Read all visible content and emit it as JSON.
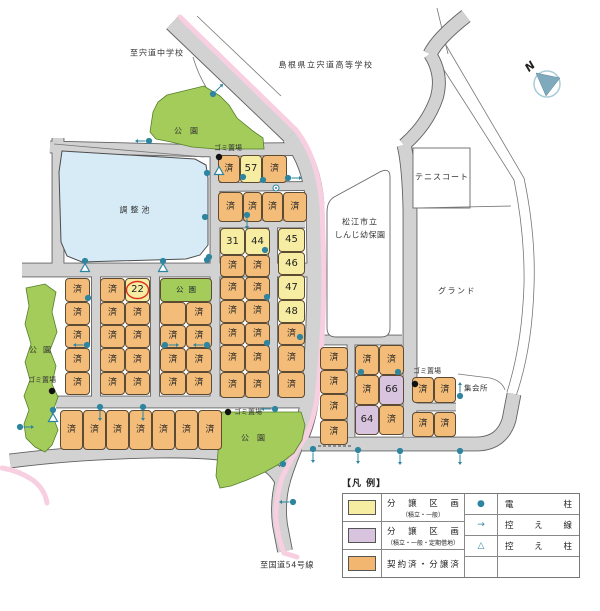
{
  "map": {
    "colors": {
      "sold_plot": "#f3bc79",
      "available_plot": "#f7eda2",
      "leasehold_plot": "#d9c4e0",
      "park": "#a3cc5a",
      "pond": "#d6ebf6",
      "road": "#d2d2d2",
      "road_edge_pink": "#f8cfe0",
      "symbol_teal": "#2e85a0",
      "highlight_red": "#e0301e"
    },
    "plots": [
      [
        218,
        155,
        22,
        28,
        "s",
        "済"
      ],
      [
        240,
        155,
        22,
        28,
        "y",
        "57"
      ],
      [
        262,
        155,
        25,
        28,
        "s",
        "済"
      ],
      [
        218,
        192,
        25,
        30,
        "s",
        "済"
      ],
      [
        243,
        192,
        19,
        30,
        "s",
        "済"
      ],
      [
        262,
        192,
        21,
        30,
        "s",
        "済"
      ],
      [
        283,
        192,
        24,
        30,
        "s",
        "済"
      ],
      [
        220,
        228,
        25,
        27,
        "y",
        "31"
      ],
      [
        245,
        228,
        25,
        27,
        "y",
        "44"
      ],
      [
        220,
        255,
        25,
        22,
        "s",
        "済"
      ],
      [
        245,
        255,
        25,
        22,
        "s",
        "済"
      ],
      [
        220,
        277,
        25,
        23,
        "s",
        "済"
      ],
      [
        245,
        277,
        25,
        23,
        "s",
        "済"
      ],
      [
        220,
        300,
        25,
        23,
        "s",
        "済"
      ],
      [
        245,
        300,
        25,
        23,
        "s",
        "済"
      ],
      [
        220,
        323,
        25,
        22,
        "s",
        "済"
      ],
      [
        245,
        323,
        25,
        22,
        "s",
        "済"
      ],
      [
        220,
        345,
        25,
        27,
        "s",
        "済"
      ],
      [
        245,
        345,
        25,
        27,
        "s",
        "済"
      ],
      [
        220,
        372,
        25,
        26,
        "s",
        "済"
      ],
      [
        245,
        372,
        25,
        26,
        "s",
        "済"
      ],
      [
        278,
        228,
        27,
        24,
        "y",
        "45"
      ],
      [
        278,
        252,
        27,
        23,
        "y",
        "46"
      ],
      [
        278,
        275,
        27,
        25,
        "y",
        "47"
      ],
      [
        278,
        300,
        27,
        23,
        "y",
        "48"
      ],
      [
        278,
        323,
        27,
        22,
        "s",
        "済"
      ],
      [
        278,
        345,
        27,
        27,
        "s",
        "済"
      ],
      [
        278,
        372,
        27,
        26,
        "s",
        "済"
      ],
      [
        65,
        278,
        25,
        24,
        "s",
        "済"
      ],
      [
        65,
        302,
        25,
        23,
        "s",
        "済"
      ],
      [
        65,
        325,
        25,
        23,
        "s",
        "済"
      ],
      [
        65,
        348,
        25,
        24,
        "s",
        "済"
      ],
      [
        65,
        372,
        25,
        23,
        "s",
        "済"
      ],
      [
        100,
        278,
        25,
        24,
        "s",
        "済"
      ],
      [
        125,
        278,
        25,
        24,
        "y",
        "22",
        1
      ],
      [
        100,
        302,
        25,
        23,
        "s",
        "済"
      ],
      [
        125,
        302,
        25,
        23,
        "s",
        "済"
      ],
      [
        100,
        325,
        25,
        23,
        "s",
        "済"
      ],
      [
        125,
        325,
        25,
        23,
        "s",
        "済"
      ],
      [
        100,
        348,
        25,
        24,
        "s",
        "済"
      ],
      [
        125,
        348,
        25,
        24,
        "s",
        "済"
      ],
      [
        100,
        372,
        25,
        23,
        "s",
        "済"
      ],
      [
        125,
        372,
        25,
        23,
        "s",
        "済"
      ],
      [
        160,
        278,
        52,
        24,
        "g",
        "公園"
      ],
      [
        160,
        302,
        26,
        23,
        "b",
        ""
      ],
      [
        186,
        302,
        26,
        23,
        "s",
        "済"
      ],
      [
        160,
        325,
        26,
        23,
        "s",
        "済"
      ],
      [
        186,
        325,
        26,
        23,
        "s",
        "済"
      ],
      [
        160,
        348,
        26,
        24,
        "s",
        "済"
      ],
      [
        186,
        348,
        26,
        24,
        "s",
        "済"
      ],
      [
        160,
        372,
        26,
        23,
        "s",
        "済"
      ],
      [
        186,
        372,
        26,
        23,
        "s",
        "済"
      ],
      [
        60,
        410,
        23,
        40,
        "s",
        "済"
      ],
      [
        83,
        410,
        23,
        40,
        "s",
        "済"
      ],
      [
        106,
        410,
        23,
        40,
        "s",
        "済"
      ],
      [
        129,
        410,
        23,
        40,
        "s",
        "済"
      ],
      [
        152,
        410,
        23,
        40,
        "s",
        "済"
      ],
      [
        175,
        410,
        23,
        40,
        "s",
        "済"
      ],
      [
        198,
        410,
        24,
        40,
        "s",
        "済"
      ],
      [
        320,
        347,
        28,
        23,
        "s",
        "済"
      ],
      [
        320,
        370,
        28,
        24,
        "s",
        "済"
      ],
      [
        320,
        394,
        28,
        26,
        "s",
        "済"
      ],
      [
        320,
        420,
        28,
        25,
        "s",
        "済"
      ],
      [
        355,
        345,
        24,
        30,
        "s",
        "済"
      ],
      [
        379,
        345,
        25,
        30,
        "s",
        "済"
      ],
      [
        355,
        375,
        24,
        30,
        "s",
        "済"
      ],
      [
        379,
        375,
        25,
        30,
        "p",
        "66"
      ],
      [
        355,
        405,
        24,
        30,
        "p",
        "64"
      ],
      [
        379,
        405,
        25,
        30,
        "s",
        "済"
      ],
      [
        412,
        377,
        22,
        26,
        "s",
        "済"
      ],
      [
        434,
        377,
        22,
        26,
        "s",
        "済"
      ],
      [
        412,
        412,
        22,
        25,
        "s",
        "済"
      ],
      [
        434,
        412,
        22,
        25,
        "s",
        "済"
      ]
    ],
    "labels": [
      {
        "t": "至宍道中学校",
        "x": 157,
        "y": 53,
        "fs": 8,
        "ls": 1
      },
      {
        "t": "島根県立宍道高等学校",
        "x": 326,
        "y": 65,
        "fs": 8,
        "ls": 1.5
      },
      {
        "t": "テニスコート",
        "x": 442,
        "y": 177,
        "fs": 8,
        "ls": 1
      },
      {
        "t": "松江市立",
        "x": 360,
        "y": 222,
        "fs": 8,
        "ls": 1
      },
      {
        "t": "しんじ幼保園",
        "x": 360,
        "y": 235,
        "fs": 8,
        "ls": 0.5
      },
      {
        "t": "グランド",
        "x": 457,
        "y": 291,
        "fs": 8,
        "ls": 1.5
      },
      {
        "t": "集会所",
        "x": 476,
        "y": 388,
        "fs": 7.5,
        "ls": 0.5
      },
      {
        "t": "調整池",
        "x": 136,
        "y": 210,
        "fs": 8,
        "ls": 3
      },
      {
        "t": "公園",
        "x": 190,
        "y": 131,
        "fs": 8,
        "ls": 8
      },
      {
        "t": "公園",
        "x": 43,
        "y": 350,
        "fs": 8,
        "ls": 6
      },
      {
        "t": "公園",
        "x": 257,
        "y": 438,
        "fs": 8,
        "ls": 8
      },
      {
        "t": "ゴミ置場",
        "x": 228,
        "y": 148,
        "fs": 7,
        "ls": 0
      },
      {
        "t": "ゴミ置場",
        "x": 42,
        "y": 380,
        "fs": 7,
        "ls": 0
      },
      {
        "t": "ゴミ置場",
        "x": 248,
        "y": 412,
        "fs": 7,
        "ls": 0
      },
      {
        "t": "ゴミ置場",
        "x": 427,
        "y": 371,
        "fs": 7,
        "ls": 0
      },
      {
        "t": "至国道54号線",
        "x": 287,
        "y": 565,
        "fs": 8,
        "ls": 0.5
      }
    ],
    "north_label": "N",
    "poles": [
      [
        207,
        173
      ],
      [
        205,
        217
      ],
      [
        85,
        261
      ],
      [
        163,
        261
      ],
      [
        207,
        260
      ],
      [
        209,
        257
      ],
      [
        265,
        250
      ],
      [
        267,
        297
      ],
      [
        267,
        343
      ],
      [
        88,
        298
      ],
      [
        243,
        177
      ],
      [
        263,
        180
      ],
      [
        288,
        178
      ],
      [
        247,
        215
      ],
      [
        300,
        337
      ],
      [
        361,
        372
      ],
      [
        398,
        372
      ],
      [
        283,
        464
      ],
      [
        53,
        410
      ],
      [
        313,
        449
      ],
      [
        358,
        450
      ],
      [
        400,
        451
      ],
      [
        460,
        451
      ],
      [
        460,
        396
      ],
      [
        20,
        427
      ],
      [
        87,
        345
      ],
      [
        165,
        345
      ],
      [
        207,
        345
      ],
      [
        100,
        407
      ],
      [
        143,
        407
      ],
      [
        275,
        409
      ],
      [
        213,
        94
      ],
      [
        149,
        141
      ],
      [
        293,
        502
      ]
    ],
    "pole_arrows": [
      [
        288,
        178,
        "E"
      ],
      [
        247,
        215,
        "S"
      ],
      [
        87,
        345,
        "W"
      ],
      [
        165,
        345,
        "E"
      ],
      [
        207,
        345,
        "W"
      ],
      [
        100,
        407,
        "S"
      ],
      [
        143,
        407,
        "S"
      ],
      [
        275,
        409,
        "W"
      ],
      [
        313,
        449,
        "S"
      ],
      [
        358,
        450,
        "S"
      ],
      [
        400,
        451,
        "S"
      ],
      [
        460,
        451,
        "S"
      ],
      [
        460,
        396,
        "N"
      ],
      [
        20,
        427,
        "E"
      ],
      [
        213,
        94,
        "NE"
      ],
      [
        149,
        141,
        "W"
      ],
      [
        293,
        502,
        "W"
      ]
    ],
    "stay_poles": [
      [
        85,
        268
      ],
      [
        163,
        268
      ],
      [
        53,
        418
      ],
      [
        219,
        171
      ]
    ],
    "trash_points": [
      [
        219,
        157
      ],
      [
        52,
        391
      ],
      [
        228,
        412
      ],
      [
        415,
        384
      ]
    ],
    "junction_marker": [
      276,
      188
    ]
  },
  "legend": {
    "title": "【凡 例】",
    "left": [
      {
        "main": "分譲区画",
        "sub": "（積立・一般）",
        "swatch": "yellow"
      },
      {
        "main": "分譲区画",
        "sub": "（積立・一般・定期借地）",
        "swatch": "purple"
      },
      {
        "main": "契約済・分譲済",
        "sub": "",
        "swatch": "orange"
      }
    ],
    "right": [
      {
        "sym": "●",
        "label": "電柱"
      },
      {
        "sym": "→",
        "label": "控え線"
      },
      {
        "sym": "△",
        "label": "控え柱"
      },
      {
        "sym": "",
        "label": ""
      }
    ]
  }
}
